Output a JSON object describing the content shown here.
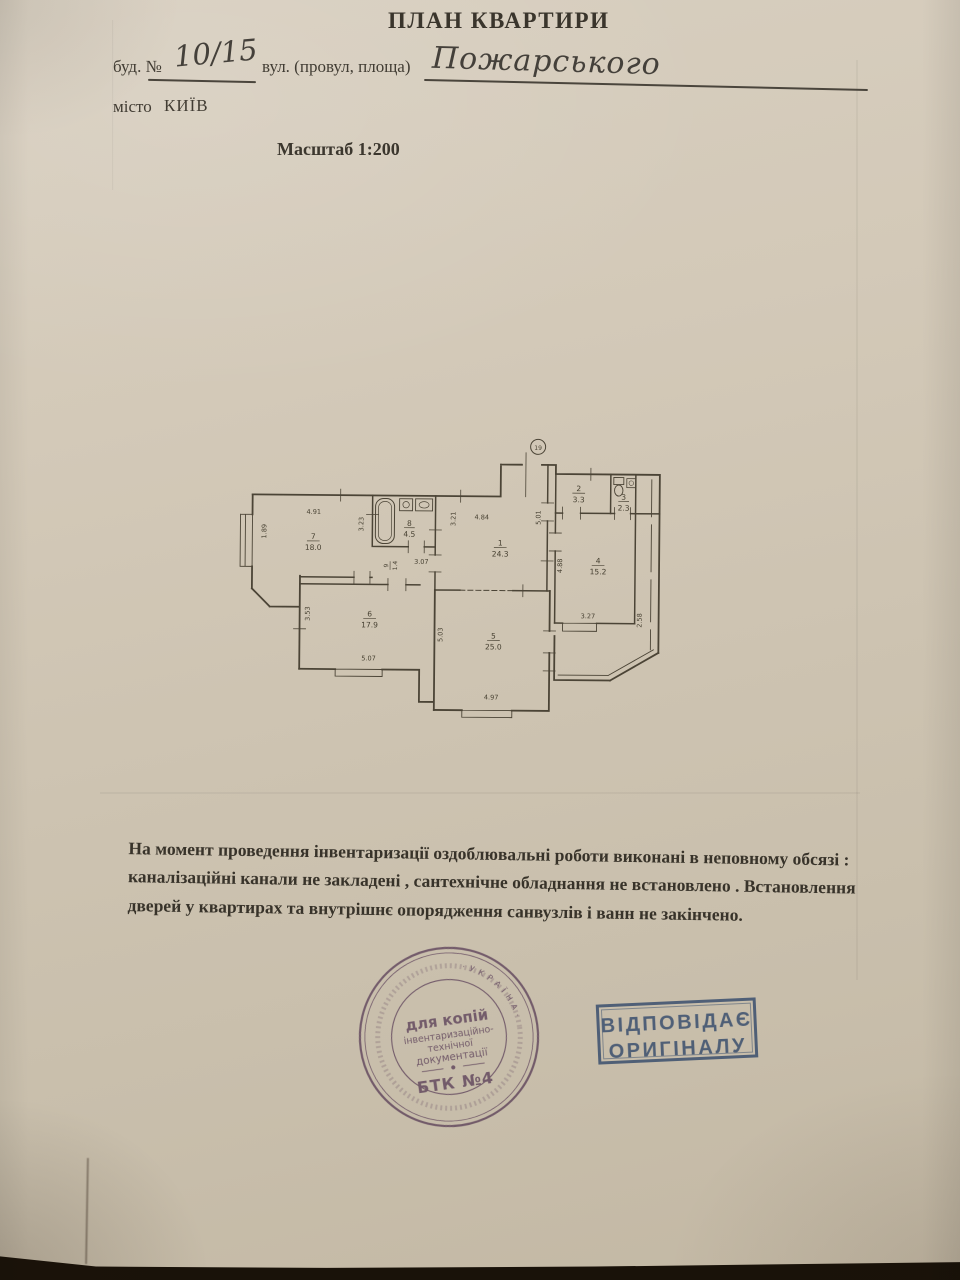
{
  "doc": {
    "title": "ПЛАН КВАРТИРИ",
    "building_label": "буд. №",
    "building_value": "10/15",
    "street_label": "вул. (провул, площа)",
    "street_value": "Пожарського",
    "city_label": "місто",
    "city_value": "КИЇВ",
    "scale": "Масштаб 1:200",
    "paper_color": "#d2c8b7",
    "ink_color": "#3e3930"
  },
  "plan": {
    "entrance_mark": "19",
    "rooms": {
      "r1": {
        "num": "1",
        "area": "24.3"
      },
      "r2": {
        "num": "2",
        "area": "3.3"
      },
      "r3": {
        "num": "3",
        "area": "2.3"
      },
      "r4": {
        "num": "4",
        "area": "15.2"
      },
      "r5": {
        "num": "5",
        "area": "25.0"
      },
      "r6": {
        "num": "6",
        "area": "17.9"
      },
      "r7": {
        "num": "7",
        "area": "18.0"
      },
      "r8": {
        "num": "8",
        "area": "4.5"
      },
      "r9": {
        "num": "9",
        "area": "1.4"
      }
    },
    "dims": {
      "room7_top": "4.91",
      "room7_window": "1.89",
      "bath_left": "3.23",
      "bath_bottom": "3.07",
      "room1_top": "4.84",
      "room1_left": "3.21",
      "room1_right": "5.01",
      "room4_left": "4.88",
      "room4_bottom": "3.27",
      "loggia_right": "2.58",
      "room6_left": "3.53",
      "room6_bottom": "5.07",
      "room5_left": "5.03",
      "room5_bottom": "4.97"
    }
  },
  "note": {
    "line1": "На момент проведення інвентаризації оздоблювальні роботи  виконані в неповному обсязі :",
    "line2": "каналізаційні канали не закладені , сантехнічне обладнання не встановлено . Встановлення",
    "line3": "дверей у квартирах  та внутрішнє опорядження санвузлів і ванн не закінчено."
  },
  "stamps": {
    "round": {
      "line1": "для копій",
      "line2": "інвентаризаційно-",
      "line3": "технічної",
      "line4": "документації",
      "line5": "БТК №4",
      "ring": "·  У К Р А Ї Н А  ·",
      "color": "#7a5c88"
    },
    "rect": {
      "line1": "ВІДПОВІДАЄ",
      "line2": "ОРИГІНАЛУ",
      "color": "#4a6aa3"
    }
  }
}
